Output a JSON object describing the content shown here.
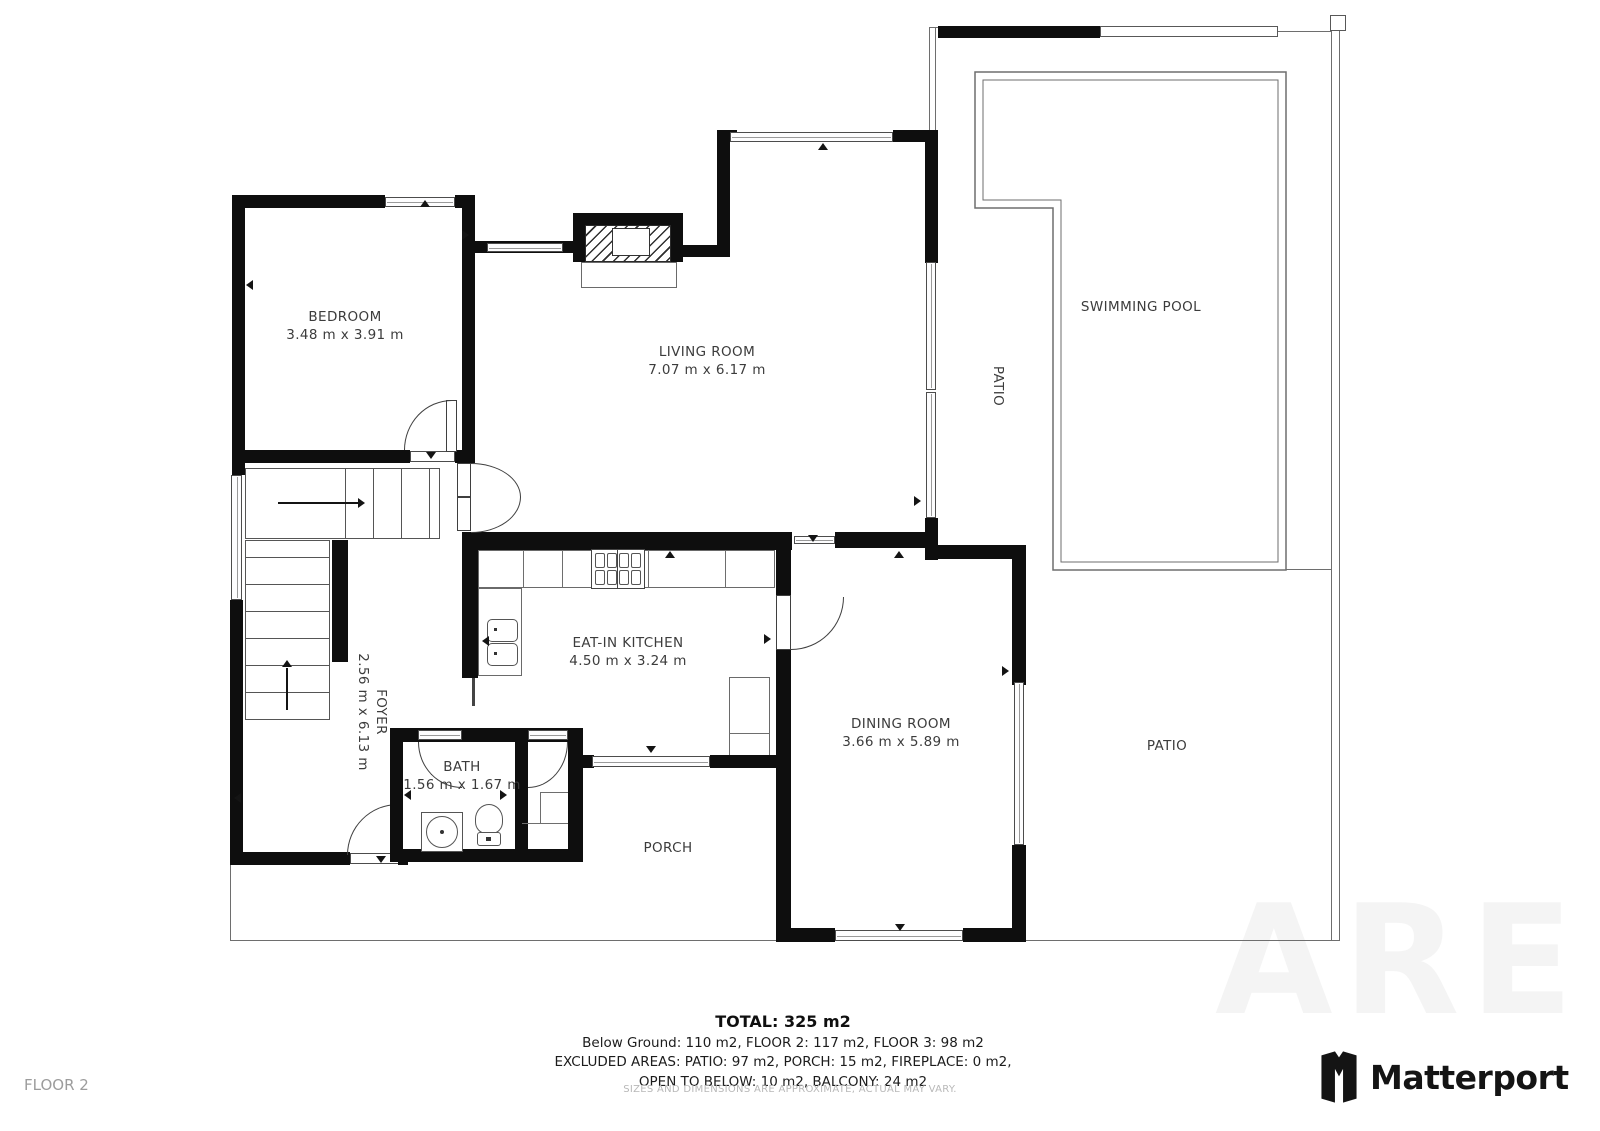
{
  "plan": {
    "rooms": {
      "bedroom": {
        "name": "BEDROOM",
        "dims": "3.48 m x 3.91 m"
      },
      "living_room": {
        "name": "LIVING ROOM",
        "dims": "7.07 m x 6.17 m"
      },
      "kitchen": {
        "name": "EAT-IN KITCHEN",
        "dims": "4.50 m x 3.24 m"
      },
      "dining_room": {
        "name": "DINING ROOM",
        "dims": "3.66 m x 5.89 m"
      },
      "bath": {
        "name": "BATH",
        "dims": "1.56 m x 1.67 m"
      },
      "foyer": {
        "name": "FOYER",
        "dims": "2.56 m x 6.13 m"
      },
      "porch": {
        "name": "PORCH"
      },
      "swimming_pool": {
        "name": "SWIMMING POOL"
      },
      "patio_side": {
        "name": "PATIO"
      },
      "patio_bottom": {
        "name": "PATIO"
      }
    }
  },
  "footer": {
    "total": "TOTAL: 325 m2",
    "floors": "Below Ground: 110 m2, FLOOR 2: 117 m2, FLOOR 3: 98 m2",
    "excluded": "EXCLUDED AREAS: PATIO: 97 m2, PORCH: 15 m2, FIREPLACE: 0 m2,",
    "excluded2": "OPEN TO BELOW: 10 m2, BALCONY: 24 m2",
    "floor_label": "FLOOR 2",
    "disclaimer": "SIZES AND DIMENSIONS ARE APPROXIMATE, ACTUAL MAY VARY."
  },
  "branding": {
    "logo_text": "Matterport",
    "watermark": "ARE"
  },
  "colors": {
    "wall": "#0e0e0e",
    "line": "#6e6e6e",
    "label": "#3c3c3c",
    "muted": "#9c9c9c",
    "faint": "#b8b8b8",
    "logo": "#141414"
  }
}
